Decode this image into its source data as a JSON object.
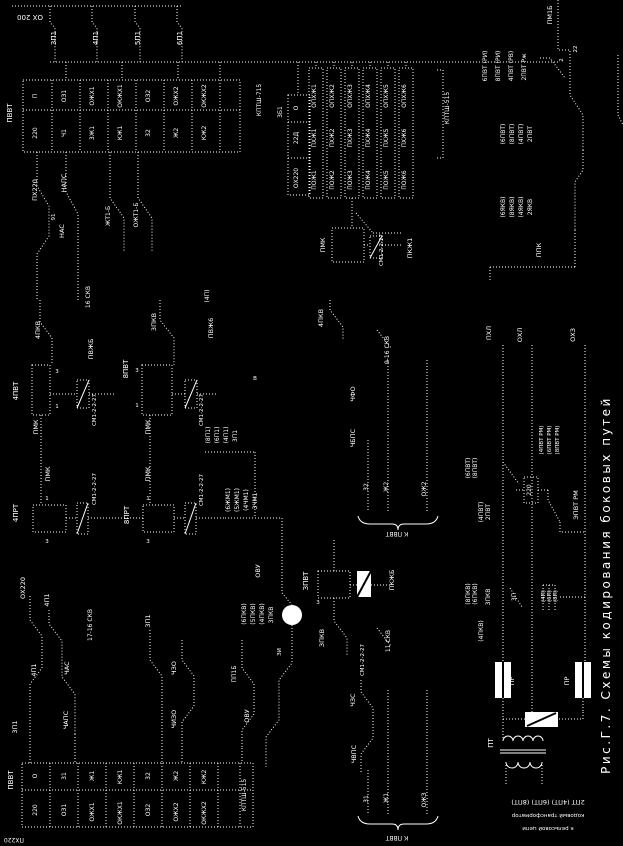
{
  "figure": {
    "title": "Рис.Г.7. Схемы кодирования боковых путей",
    "type": "relay-circuit-schematic",
    "orientation": "rotated-90"
  },
  "colors": {
    "background": "#000000",
    "line": "#ffffff"
  },
  "caption": {
    "line1": "2ПТ (4ПТ) (6ПТ) (8ПТ)",
    "line2": "кодовый трансформатор",
    "line3": "к рельсовой цепи"
  },
  "labels": [
    {
      "t": "ОХ 200",
      "x": 30,
      "y": 15,
      "r": 180,
      "s": 7
    },
    {
      "t": "3П1",
      "x": 56,
      "y": 38,
      "s": 7
    },
    {
      "t": "4П1",
      "x": 98,
      "y": 38,
      "s": 7
    },
    {
      "t": "5П1",
      "x": 140,
      "y": 38,
      "s": 7
    },
    {
      "t": "6П1",
      "x": 182,
      "y": 38,
      "s": 7
    },
    {
      "t": "ПВВТ",
      "x": 12,
      "y": 113,
      "s": 7
    },
    {
      "t": "П",
      "x": 37,
      "y": 96
    },
    {
      "t": "220",
      "x": 37,
      "y": 133
    },
    {
      "t": "ОЗ1",
      "x": 66,
      "y": 96
    },
    {
      "t": "Ч1",
      "x": 66,
      "y": 133
    },
    {
      "t": "ОЖХ1",
      "x": 94,
      "y": 96
    },
    {
      "t": "3Ж1",
      "x": 94,
      "y": 133
    },
    {
      "t": "ОКЖХ1",
      "x": 122,
      "y": 96
    },
    {
      "t": "КЖ1",
      "x": 122,
      "y": 133
    },
    {
      "t": "ОЗ2",
      "x": 150,
      "y": 96
    },
    {
      "t": "32",
      "x": 150,
      "y": 133
    },
    {
      "t": "ОЖХ2",
      "x": 178,
      "y": 96
    },
    {
      "t": "Ж2",
      "x": 178,
      "y": 133
    },
    {
      "t": "ОКЖХ2",
      "x": 206,
      "y": 96
    },
    {
      "t": "КЖ2",
      "x": 206,
      "y": 133
    },
    {
      "t": "КПТШ-715",
      "x": 261,
      "y": 100
    },
    {
      "t": "3Б1",
      "x": 282,
      "y": 112
    },
    {
      "t": "О",
      "x": 298,
      "y": 108
    },
    {
      "t": "22Д",
      "x": 298,
      "y": 138
    },
    {
      "t": "ОХ220",
      "x": 298,
      "y": 178
    },
    {
      "t": "ОПХЖ1",
      "x": 316,
      "y": 96
    },
    {
      "t": "ПХЖ1",
      "x": 316,
      "y": 138
    },
    {
      "t": "ПОЖ1",
      "x": 316,
      "y": 180
    },
    {
      "t": "ОПХЖ2",
      "x": 334,
      "y": 96
    },
    {
      "t": "ПХЖ2",
      "x": 334,
      "y": 138
    },
    {
      "t": "ПОЖ2",
      "x": 334,
      "y": 180
    },
    {
      "t": "ОПХЖ3",
      "x": 352,
      "y": 96
    },
    {
      "t": "ПХЖ3",
      "x": 352,
      "y": 138
    },
    {
      "t": "ПОЖ3",
      "x": 352,
      "y": 180
    },
    {
      "t": "ОПХЖ4",
      "x": 370,
      "y": 96
    },
    {
      "t": "ПХЖ4",
      "x": 370,
      "y": 138
    },
    {
      "t": "ПОЖ4",
      "x": 370,
      "y": 180
    },
    {
      "t": "ОПХЖ5",
      "x": 388,
      "y": 96
    },
    {
      "t": "ПХЖ5",
      "x": 388,
      "y": 138
    },
    {
      "t": "ПОЖ5",
      "x": 388,
      "y": 180
    },
    {
      "t": "ОПХЖ6",
      "x": 406,
      "y": 96
    },
    {
      "t": "ПХЖ6",
      "x": 406,
      "y": 138
    },
    {
      "t": "ПОЖ6",
      "x": 406,
      "y": 180
    },
    {
      "t": "КПТШ-515",
      "x": 449,
      "y": 108
    },
    {
      "t": "ПМК",
      "x": 325,
      "y": 245,
      "s": 6.5
    },
    {
      "t": "СМ1-2-2-27",
      "x": 383,
      "y": 250,
      "s": 5.5
    },
    {
      "t": "ПКЖ1",
      "x": 412,
      "y": 248,
      "s": 6.5
    },
    {
      "t": "ПМ1Б",
      "x": 552,
      "y": 15,
      "s": 6.5
    },
    {
      "t": "22",
      "x": 577,
      "y": 49,
      "s": 5.5
    },
    {
      "t": "2",
      "x": 563,
      "y": 60,
      "s": 5.5
    },
    {
      "t": "6ПВТ (РИ)",
      "x": 487,
      "y": 66,
      "s": 6
    },
    {
      "t": "8ПВТ (РИ)",
      "x": 500,
      "y": 66,
      "s": 6
    },
    {
      "t": "4ПВТ (РВ)",
      "x": 513,
      "y": 66,
      "s": 6
    },
    {
      "t": "2ПВТ Рж",
      "x": 526,
      "y": 67,
      "s": 6
    },
    {
      "t": "(6ПВТ)",
      "x": 505,
      "y": 134,
      "s": 6
    },
    {
      "t": "(8ПВТ)",
      "x": 514,
      "y": 134,
      "s": 6
    },
    {
      "t": "(4ПВТ)",
      "x": 523,
      "y": 134,
      "s": 6
    },
    {
      "t": "2ПВТ",
      "x": 532,
      "y": 134,
      "s": 6
    },
    {
      "t": "(6ЯКВ)",
      "x": 505,
      "y": 207,
      "s": 6
    },
    {
      "t": "(8ЯКВ)",
      "x": 514,
      "y": 207,
      "s": 6
    },
    {
      "t": "(4ЯКВ)",
      "x": 523,
      "y": 207,
      "s": 6
    },
    {
      "t": "2ЯКВ",
      "x": 532,
      "y": 207,
      "s": 6
    },
    {
      "t": "ППК",
      "x": 541,
      "y": 250,
      "s": 6.5
    },
    {
      "t": "ПХ220",
      "x": 37,
      "y": 190,
      "s": 6.5
    },
    {
      "t": "НАПС",
      "x": 66,
      "y": 183,
      "s": 6.5
    },
    {
      "t": "91",
      "x": 55,
      "y": 217,
      "s": 5.5
    },
    {
      "t": "НАС",
      "x": 64,
      "y": 231,
      "s": 6.5
    },
    {
      "t": "ЖТ1-Б",
      "x": 110,
      "y": 216,
      "s": 6
    },
    {
      "t": "ОЖТ1-Б",
      "x": 138,
      "y": 215,
      "s": 6
    },
    {
      "t": "16 СКВ",
      "x": 90,
      "y": 297,
      "s": 6
    },
    {
      "t": "4ПКВ",
      "x": 40,
      "y": 330,
      "s": 6.5
    },
    {
      "t": "4ПВТ",
      "x": 18,
      "y": 391,
      "s": 7
    },
    {
      "t": "3",
      "x": 57,
      "y": 373,
      "r": 0,
      "s": 5.5
    },
    {
      "t": "1",
      "x": 57,
      "y": 408,
      "r": 0,
      "s": 5.5
    },
    {
      "t": "ПМК",
      "x": 38,
      "y": 427,
      "s": 6.5
    },
    {
      "t": "СМ1-2-2-27",
      "x": 96,
      "y": 410,
      "s": 5.5
    },
    {
      "t": "ПВЖБ",
      "x": 93,
      "y": 349,
      "s": 6.5
    },
    {
      "t": "8ПВТ",
      "x": 128,
      "y": 369,
      "s": 7
    },
    {
      "t": "3",
      "x": 137,
      "y": 372,
      "r": 0,
      "s": 5.5
    },
    {
      "t": "1",
      "x": 137,
      "y": 407,
      "r": 0,
      "s": 5.5
    },
    {
      "t": "ПМК",
      "x": 150,
      "y": 427,
      "s": 6.5
    },
    {
      "t": "СМ1-2-2-27",
      "x": 203,
      "y": 410,
      "s": 5.5
    },
    {
      "t": "3ПКВ",
      "x": 156,
      "y": 322,
      "s": 6.5
    },
    {
      "t": "ПВЖ6",
      "x": 213,
      "y": 328,
      "s": 6.5
    },
    {
      "t": "(4П)",
      "x": 209,
      "y": 296,
      "s": 6
    },
    {
      "t": "В",
      "x": 255,
      "y": 380,
      "r": 0,
      "s": 5.5
    },
    {
      "t": "4ПРТ",
      "x": 18,
      "y": 513,
      "s": 7
    },
    {
      "t": "1",
      "x": 47,
      "y": 500,
      "r": 0,
      "s": 5.5
    },
    {
      "t": "3",
      "x": 47,
      "y": 543,
      "r": 0,
      "s": 5.5
    },
    {
      "t": "ПМК",
      "x": 50,
      "y": 474,
      "s": 6.5
    },
    {
      "t": "СМ1-2-2-27",
      "x": 96,
      "y": 489,
      "s": 5.5
    },
    {
      "t": "8ПРТ",
      "x": 129,
      "y": 515,
      "s": 7
    },
    {
      "t": "1",
      "x": 148,
      "y": 500,
      "r": 0,
      "s": 5.5
    },
    {
      "t": "3",
      "x": 148,
      "y": 543,
      "r": 0,
      "s": 5.5
    },
    {
      "t": "ПМК",
      "x": 150,
      "y": 474,
      "s": 6.5
    },
    {
      "t": "СМ1-2-2-27",
      "x": 203,
      "y": 490,
      "s": 5.5
    },
    {
      "t": "(8П1)",
      "x": 210,
      "y": 435,
      "s": 6
    },
    {
      "t": "(6П1)",
      "x": 219,
      "y": 435,
      "s": 6
    },
    {
      "t": "(4П1)",
      "x": 228,
      "y": 435,
      "s": 6
    },
    {
      "t": "3П1",
      "x": 237,
      "y": 436,
      "s": 6
    },
    {
      "t": "(6ЖМ1)",
      "x": 230,
      "y": 500,
      "s": 6
    },
    {
      "t": "(5ЖМ1)",
      "x": 239,
      "y": 500,
      "s": 6
    },
    {
      "t": "(4ЧМ1)",
      "x": 248,
      "y": 500,
      "s": 6
    },
    {
      "t": "3ЧМ1",
      "x": 257,
      "y": 501,
      "s": 6
    },
    {
      "t": "ОХ220",
      "x": 25,
      "y": 588,
      "s": 6.5
    },
    {
      "t": "4П1",
      "x": 49,
      "y": 600,
      "s": 6.5
    },
    {
      "t": "17-16 СКВ",
      "x": 92,
      "y": 625,
      "s": 6
    },
    {
      "t": "3П1",
      "x": 150,
      "y": 621,
      "s": 6.5
    },
    {
      "t": "4П1",
      "x": 36,
      "y": 670,
      "s": 6.5
    },
    {
      "t": "ЧАС",
      "x": 69,
      "y": 668,
      "s": 6.5
    },
    {
      "t": "ЧАПС",
      "x": 68,
      "y": 720,
      "s": 6.5
    },
    {
      "t": "3П1",
      "x": 17,
      "y": 727,
      "s": 6.5
    },
    {
      "t": "ЧЗО",
      "x": 176,
      "y": 668,
      "s": 6.5
    },
    {
      "t": "ЧИЗО",
      "x": 176,
      "y": 719,
      "s": 6.5
    },
    {
      "t": "ПП1Б",
      "x": 236,
      "y": 674,
      "s": 6
    },
    {
      "t": "ОВУ",
      "x": 249,
      "y": 716,
      "s": 6.5
    },
    {
      "t": "ОВУ",
      "x": 260,
      "y": 571,
      "s": 6.5
    },
    {
      "t": "(6ПКВ)",
      "x": 246,
      "y": 614,
      "s": 6
    },
    {
      "t": "(5ПКВ)",
      "x": 255,
      "y": 614,
      "s": 6
    },
    {
      "t": "(4ПКВ)",
      "x": 264,
      "y": 614,
      "s": 6
    },
    {
      "t": "3ПКВ",
      "x": 273,
      "y": 615,
      "s": 6
    },
    {
      "t": "ЗИ",
      "x": 281,
      "y": 652,
      "s": 5.5
    },
    {
      "t": "ПВВТ",
      "x": 13,
      "y": 780,
      "s": 7
    },
    {
      "t": "О",
      "x": 37,
      "y": 776
    },
    {
      "t": "220",
      "x": 37,
      "y": 810
    },
    {
      "t": "31",
      "x": 66,
      "y": 776
    },
    {
      "t": "ОЗ1",
      "x": 66,
      "y": 810
    },
    {
      "t": "Ж1",
      "x": 94,
      "y": 776
    },
    {
      "t": "ОЖХ1",
      "x": 94,
      "y": 812
    },
    {
      "t": "КЖ1",
      "x": 122,
      "y": 777
    },
    {
      "t": "ОКЖХ1",
      "x": 122,
      "y": 813
    },
    {
      "t": "32",
      "x": 150,
      "y": 776
    },
    {
      "t": "ОЗ2",
      "x": 150,
      "y": 810
    },
    {
      "t": "Ж2",
      "x": 178,
      "y": 776
    },
    {
      "t": "ОЖХ2",
      "x": 178,
      "y": 812
    },
    {
      "t": "КЖ2",
      "x": 206,
      "y": 777
    },
    {
      "t": "ОКЖХ2",
      "x": 206,
      "y": 813
    },
    {
      "t": "КПТШ-515",
      "x": 246,
      "y": 795
    },
    {
      "t": "ПХ220",
      "x": 14,
      "y": 838,
      "r": 180,
      "s": 6
    },
    {
      "t": "ЗПВТ",
      "x": 308,
      "y": 581,
      "s": 7
    },
    {
      "t": "3",
      "x": 318,
      "y": 604,
      "r": 0,
      "s": 5.5
    },
    {
      "t": "ПКЖБ",
      "x": 394,
      "y": 580,
      "s": 6.5
    },
    {
      "t": "ЗПКВ",
      "x": 324,
      "y": 638,
      "s": 6.5
    },
    {
      "t": "СМ1-2-2-27",
      "x": 364,
      "y": 660,
      "s": 5.5
    },
    {
      "t": "11 СКВ",
      "x": 390,
      "y": 641,
      "s": 6
    },
    {
      "t": "ЧЗС",
      "x": 355,
      "y": 700,
      "s": 6.5
    },
    {
      "t": "ЧВПС",
      "x": 356,
      "y": 754,
      "s": 6.5
    },
    {
      "t": "31",
      "x": 368,
      "y": 799,
      "s": 6
    },
    {
      "t": "Ж1",
      "x": 388,
      "y": 798,
      "s": 6
    },
    {
      "t": "ОЖЗ",
      "x": 426,
      "y": 800,
      "s": 6
    },
    {
      "t": "К ПВВТ",
      "x": 397,
      "y": 836,
      "r": 180,
      "s": 6
    },
    {
      "t": "4ПКВ",
      "x": 323,
      "y": 318,
      "s": 6.5
    },
    {
      "t": "9-16 СКВ",
      "x": 389,
      "y": 350,
      "s": 6
    },
    {
      "t": "ЧФО",
      "x": 355,
      "y": 394,
      "s": 6.5
    },
    {
      "t": "ЧБПС",
      "x": 355,
      "y": 438,
      "s": 6.5
    },
    {
      "t": "32",
      "x": 368,
      "y": 487,
      "s": 6
    },
    {
      "t": "Ж2",
      "x": 388,
      "y": 487,
      "s": 6
    },
    {
      "t": "ОЖ2",
      "x": 426,
      "y": 489,
      "s": 6
    },
    {
      "t": "К ПВВТ",
      "x": 397,
      "y": 532,
      "r": 180,
      "s": 6
    },
    {
      "t": "ПХЛ",
      "x": 491,
      "y": 333,
      "s": 6.5
    },
    {
      "t": "ОХЛ",
      "x": 522,
      "y": 335,
      "s": 6.5
    },
    {
      "t": "ОХЗ",
      "x": 575,
      "y": 335,
      "s": 6.5
    },
    {
      "t": "(6ПВТ)",
      "x": 470,
      "y": 468,
      "s": 6
    },
    {
      "t": "(8ПВТ)",
      "x": 477,
      "y": 468,
      "s": 6
    },
    {
      "t": "(4ПВТ)",
      "x": 483,
      "y": 512,
      "s": 6
    },
    {
      "t": "2ПВТ",
      "x": 490,
      "y": 512,
      "s": 6
    },
    {
      "t": "220",
      "x": 531,
      "y": 490,
      "s": 6
    },
    {
      "t": "(4ПВТ РМ)",
      "x": 543,
      "y": 440,
      "s": 5.5
    },
    {
      "t": "(6ПВТ РМ)",
      "x": 551,
      "y": 440,
      "s": 5.5
    },
    {
      "t": "(8ПВТ РМ)",
      "x": 559,
      "y": 440,
      "s": 5.5
    },
    {
      "t": "ЭПВТ РМ",
      "x": 578,
      "y": 505,
      "s": 6.5
    },
    {
      "t": "(8ПКВ)",
      "x": 470,
      "y": 594,
      "s": 6
    },
    {
      "t": "(6ПКВ)",
      "x": 477,
      "y": 594,
      "s": 6
    },
    {
      "t": "(4ПКВ)",
      "x": 483,
      "y": 631,
      "s": 6
    },
    {
      "t": "3ПКВ",
      "x": 490,
      "y": 597,
      "s": 6
    },
    {
      "t": "3П",
      "x": 516,
      "y": 597,
      "s": 6
    },
    {
      "t": "(4П)",
      "x": 545,
      "y": 596,
      "s": 5.5
    },
    {
      "t": "(6П)",
      "x": 551,
      "y": 596,
      "s": 5.5
    },
    {
      "t": "(8П)",
      "x": 557,
      "y": 596,
      "s": 5.5
    },
    {
      "t": "ПР",
      "x": 514,
      "y": 681,
      "s": 6.5
    },
    {
      "t": "ПР",
      "x": 569,
      "y": 681,
      "s": 6.5
    },
    {
      "t": "ПТ",
      "x": 493,
      "y": 743,
      "s": 7
    },
    {
      "t": "2ПТ (4ПТ) (6ПТ) (8ПТ)",
      "x": 548,
      "y": 800,
      "r": 180,
      "s": 6.5
    },
    {
      "t": "кодовый трансформатор",
      "x": 548,
      "y": 814,
      "r": 180,
      "s": 5.5
    },
    {
      "t": "к рельсовой цепи",
      "x": 548,
      "y": 827,
      "r": 180,
      "s": 5.5
    },
    {
      "t": "Рис.Г.7. Схемы кодирования боковых путей",
      "x": 610,
      "y": 585,
      "s": 12,
      "ls": 2.5
    }
  ]
}
